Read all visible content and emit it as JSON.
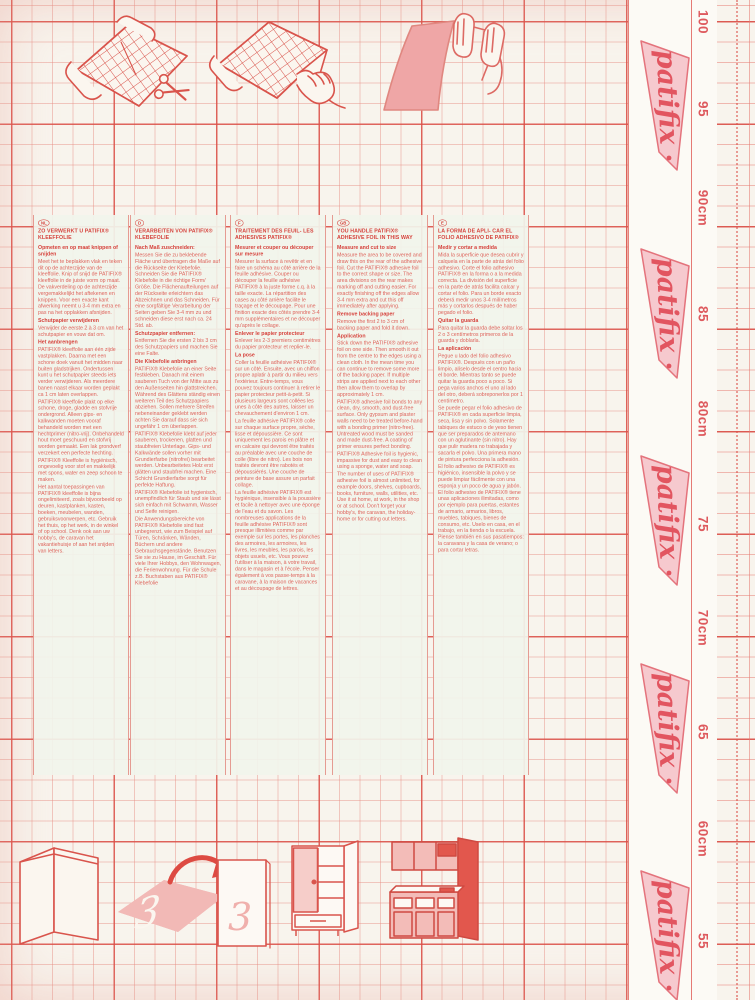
{
  "brand": {
    "logo_text": "patifix",
    "ink_color": "#dd5a52",
    "flag_pink": "#f6c9ce"
  },
  "ruler": {
    "labels": [
      "100",
      "95",
      "90cm",
      "85",
      "80cm",
      "75",
      "70cm",
      "65",
      "60cm",
      "55"
    ],
    "unit": "cm"
  },
  "bottom_illustrations": {
    "numeral": "3"
  },
  "illustrations": {
    "top": [
      "unroll-and-cut-foil",
      "peel-backing-paper",
      "smooth-foil-by-hand"
    ],
    "bottom": [
      "covered-panel-corner",
      "cut-numeral-applied-to-door",
      "wardrobe-cabinet",
      "kitchen-unit"
    ]
  },
  "columns": [
    {
      "code": "NL",
      "title": "ZO VERWERKT U PATIFIX® KLEEFFOLIE",
      "paragraphs": [
        {
          "b": true,
          "t": "Opmeten en op maat knippen of snijden"
        },
        {
          "t": "Meet het te beplakken vlak en teken dit op de achterzijde van de kleeffolie. Knip of snijd de PATIFIX® kleeffolie in de juiste vorm op maat. De vakverdeling op de achterzijde vergemakkelijkt het aftekenen en knippen. Voor een exacte kant afwerking neemt u 3-4 mm extra en pas na het opplakken afsnijden."
        },
        {
          "b": true,
          "t": "Schutpapier verwijderen"
        },
        {
          "t": "Verwijder de eerste 2 à 3 cm van het schutpapier en vouw dat om."
        },
        {
          "b": true,
          "t": "Het aanbrengen"
        },
        {
          "t": "PATIFIX® kleeffolie aan één zijde vastplakken. Daarna met een schone doek vanuit het midden naar buiten gladstrijken. Ondertussen kunt u het schutpapier steeds iets verder verwijderen. Als meerdere banen naast elkaar worden geplakt ca 1 cm laten overlappen."
        },
        {
          "t": "PATIFIX® kleeffolie plakt op elke schone, droge, gladde en stofvrije ondergrond. Alleen gips- en kalkwanden moeten vooraf behandeld worden met een hechtprimer (nitro-vrij). Onbehandeld hout moet geschuurd en stofvrij worden gemaakt. Een lak grondverf verzekert een perfecte hechting."
        },
        {
          "t": "PATIFIX® Kleeffolie is hygiënisch, ongevoelig voor stof en makkelijk met spons, water en zeep schoon te maken."
        },
        {
          "t": "Het aantal toepassingen van PATIFIX® kleeffolie is bijna ongelimiteerd, zoals bijvoorbeeld op deuren, kastplanken, kasten, boeken, meubelen, wanden, gebruiksvoorwerpen, etc. Gebruik het thuis, op het werk, in de winkel of op school. Denk ook aan uw hobby's, de caravan het vakantiehuisje of aan het snijden van letters."
        }
      ]
    },
    {
      "code": "D",
      "title": "VERARBEITEN VON PATIFIX® KLEBEFOLIE",
      "paragraphs": [
        {
          "b": true,
          "t": "Nach Maß zuschneiden:"
        },
        {
          "t": "Messen Sie die zu beklebende Fläche und übertragen die Maße auf die Rückseite der Klebefolie. Schneiden Sie die PATIFIX® Klebefolie in die richtige Form/ Größe. Die Flächenaufteilungen auf der Rückseite erleichtern das Abzeichnen und das Schneiden. Für eine sorgfältige Verarbeitung der Seiten geben Sie 3-4 mm zu und schneiden diese erst nach ca. 24 Std. ab."
        },
        {
          "b": true,
          "t": "Schutzpapier entfernen:"
        },
        {
          "t": "Entfernen Sie die ersten 2 bis 3 cm des Schutzpapiers und machen Sie eine Falte."
        },
        {
          "b": true,
          "t": "Die Klebefolie anbringen"
        },
        {
          "t": "PATIFIX® Klebefolie an einer Seite festkleben. Danach mit einem sauberen Tuch von der Mitte aus zu den Außenseiten hin glattstreichen. Während des Glättens ständig einen weiteren Teil des Schutzpapiers abziehen. Sollen mehrere Streifen nebeneinander geklebt werden achten Sie darauf dass sie sich ungefähr 1 cm überlappen."
        },
        {
          "t": "PATIFIX® Klebefolie klebt auf jeder sauberen, trockenen, glatten und staubfreien Unterlage. Gips- und Kalkwände sollen vorher mit Grundierfarbe (nitrofrei) bearbeitet werden. Unbearbeitetes Holz erst glätten und staubfrei machen. Eine Schicht Grundierfarbe sorgt für perfekte Haftung."
        },
        {
          "t": "PATIFIX® Klebefolie ist hygienisch, unempfindlich für Staub und sie lässt sich einfach mit Schwamm, Wasser und Seife reinigen."
        },
        {
          "t": "Die Anwendungsbereiche von PATIFIX® Klebefolie sind fast unbegrenzt, wie zum Beispiel auf Türen, Schränken, Wänden, Büchern und andere Gebrauchsgegenstände. Benutzen Sie sie zu Hause, im Geschäft. Für viele Ihrer Hobbys, den Wohnwagen, die Ferienwohnung. Für die Schule z.B. Buchstaben aus PATIFIX® Klebefolie"
        }
      ]
    },
    {
      "code": "F",
      "title": "TRAITEMENT DES FEUIL- LES ADHESIVES PATIFIX®",
      "paragraphs": [
        {
          "b": true,
          "t": "Mesurer et couper ou découper sur mesure"
        },
        {
          "t": "Mesurer la surface à revêtir et en faire un schéma au côté arrière de la feuille adhésive. Couper ou découper la feuille adhésive PATIFIX® à la juste forme c.q. à la taille exacte. La répartition des cases au côté arrière facilite le traçage et le découpage. Pour une finition exacte des côtés prendre 3-4 mm supplémentaires et ne découper qu'après le collage."
        },
        {
          "b": true,
          "t": "Enlever le papier protecteur"
        },
        {
          "t": "Enlever les 2-3 premiers centimètres du papier protecteur et replier-le."
        },
        {
          "b": true,
          "t": "La pose"
        },
        {
          "t": "Coller la feuille adhésive PATIFIX® sur un côté. Ensuite, avec un chiffon propre aplatir à partir du milieu vers l'extérieur. Entre-temps, vous pouvez toujours continuer à retirer le papier protecteur petit-à-petit. Si plusieurs largeurs sont collées les unes à côté des autres, laisser un chevauchement d'environ 1 cm."
        },
        {
          "t": "La feuille adhésive PATIFIX® colle sur chaque surface propre, sèche, lisse et dépoussière. Ce sont uniquement les parois en plâtre et en calcaire qui devront être traités au préalable avec une couche de colle (libre de nitro). Les bois non traités devront être rabotés et dépoussiérés. Une couche de peinture de base assure un parfait collage."
        },
        {
          "t": "La feuille adhésive PATIFIX® est hygiénique, insensible à la poussière et facile à nettoyer avec une éponge de l'eau et du savon. Les nombreuses applications de la feuille adhésive PATIFIX® sont presque illimitées comme par exemple sur les portes, les planches des armoires, les armoires, les livres, les meubles, les parois, les objets usuels, etc. Vous pouvez l'utiliser à la maison, à votre travail, dans le magasin et à l'école. Penser également à vos passe-temps à la caravane, à la maison de vacances et au découpage de lettres."
        }
      ]
    },
    {
      "code": "GB",
      "title": "YOU HANDLE PATIFIX® ADHESIVE FOIL IN THIS WAY",
      "paragraphs": [
        {
          "b": true,
          "t": "Measure and cut to size"
        },
        {
          "t": "Measure the area to be covered and draw this on the rear of the adhesive foil. Cut the PATIFIX® adhesive foil to the correct shape or size. The area divisions on the rear makes marking off and cutting easier. For exactly finishing off the edges allow 3-4 mm extra and cut this off immediately after applying."
        },
        {
          "b": true,
          "t": "Remove backing paper"
        },
        {
          "t": "Remove the first 2 to 3 cm of backing paper and fold it down."
        },
        {
          "b": true,
          "t": "Application"
        },
        {
          "t": "Stick down the PATIFIX® adhesive foil on one side. Then smooth it out from the centre to the edges using a clean cloth. In the mean time you can continue to remove some more of the backing paper. If multiple strips are applied next to each other then allow them to overlap by approximately 1 cm."
        },
        {
          "t": "PATIFIX® adhesive foil bonds to any clean, dry, smooth, and dust-free surface. Only gypsum and plaster walls need to be treated before-hand with a bonding primer (nitro-free). Untreated wood must be sanded and made dust-free. A coating of primer ensures perfect bonding."
        },
        {
          "t": "PATIFIX® Adhesive foil is hygienic, impassive for dust and easy to clean using a sponge, water and soap."
        },
        {
          "t": "The number of uses of PATIFIX® adhesive foil is almost unlimited, for example doors, shelves, cupboards, books, furniture, walls, utilities, etc. Use it at home, at work, in the shop or at school. Don't forget your hobby's, the caravan, the holiday-home or for cutting out letters."
        }
      ]
    },
    {
      "code": "E",
      "title": "LA FORMA DE APLI- CAR EL FOLIO ADHESIVO DE PATIFIX®",
      "paragraphs": [
        {
          "b": true,
          "t": "Medir y cortar a medida"
        },
        {
          "t": "Mida la superficie que desea cubrir y calquela en la parte de atrás del folio adhesivo. Corte el folio adhesivo PATIFIX® en la forma o a la medida correcta. La división del superficie en la parte de atrás facilita calcar y cortar el folio. Para un borde exacto deberá medir unos 3-4 milímetros más y cortarlos después de haber pegado el folio."
        },
        {
          "b": true,
          "t": "Quitar la guarda"
        },
        {
          "t": "Para quitar la guarda debe soltar los 2 o 3 centímetros primeros de la guarda y doblarla."
        },
        {
          "b": true,
          "t": "La aplicación"
        },
        {
          "t": "Pegue u lado del folio adhesivo PATIFIX®. Después con un paño limpio, alíselo desde el centro hacia el borde. Mientras tanto se puede quitar la guarda poco a poco. Si pega varios anchos el uno al lado del otro, deberá sobreponerlos por 1 centímetro."
        },
        {
          "t": "Se puede pegar el folio adhesivo de PATIFIX® en cada superficie limpia, seca, lisa y sin polvo. Solamente tabiques de estuco o de yeso tienen que ser preparados de antemano con un aglutinante (sin nitro). Hay que pulir madera no trabajada y sacarla el polvo. Una primera mano de pintura perfecciona la adhesión."
        },
        {
          "t": "El folio adhesivo de PATIFIX® es higiénico, insensible la polvo y se puede limpiar fácilmente con una esponja y un poco de agua y jabón. El folio adhesivo de PATIFIX® tiene unas aplicaciones ilimitadas, como por ejemplo para puertas, estantes de armario, armarios, libros, muebles, tabiques, bienes de consumo, etc. Uselo en casa, en el trabajo, en la tienda o la escuela. Piense también en sus pasatiempos: la caravana y la casa de verano; o para cortar letras."
        }
      ]
    }
  ]
}
